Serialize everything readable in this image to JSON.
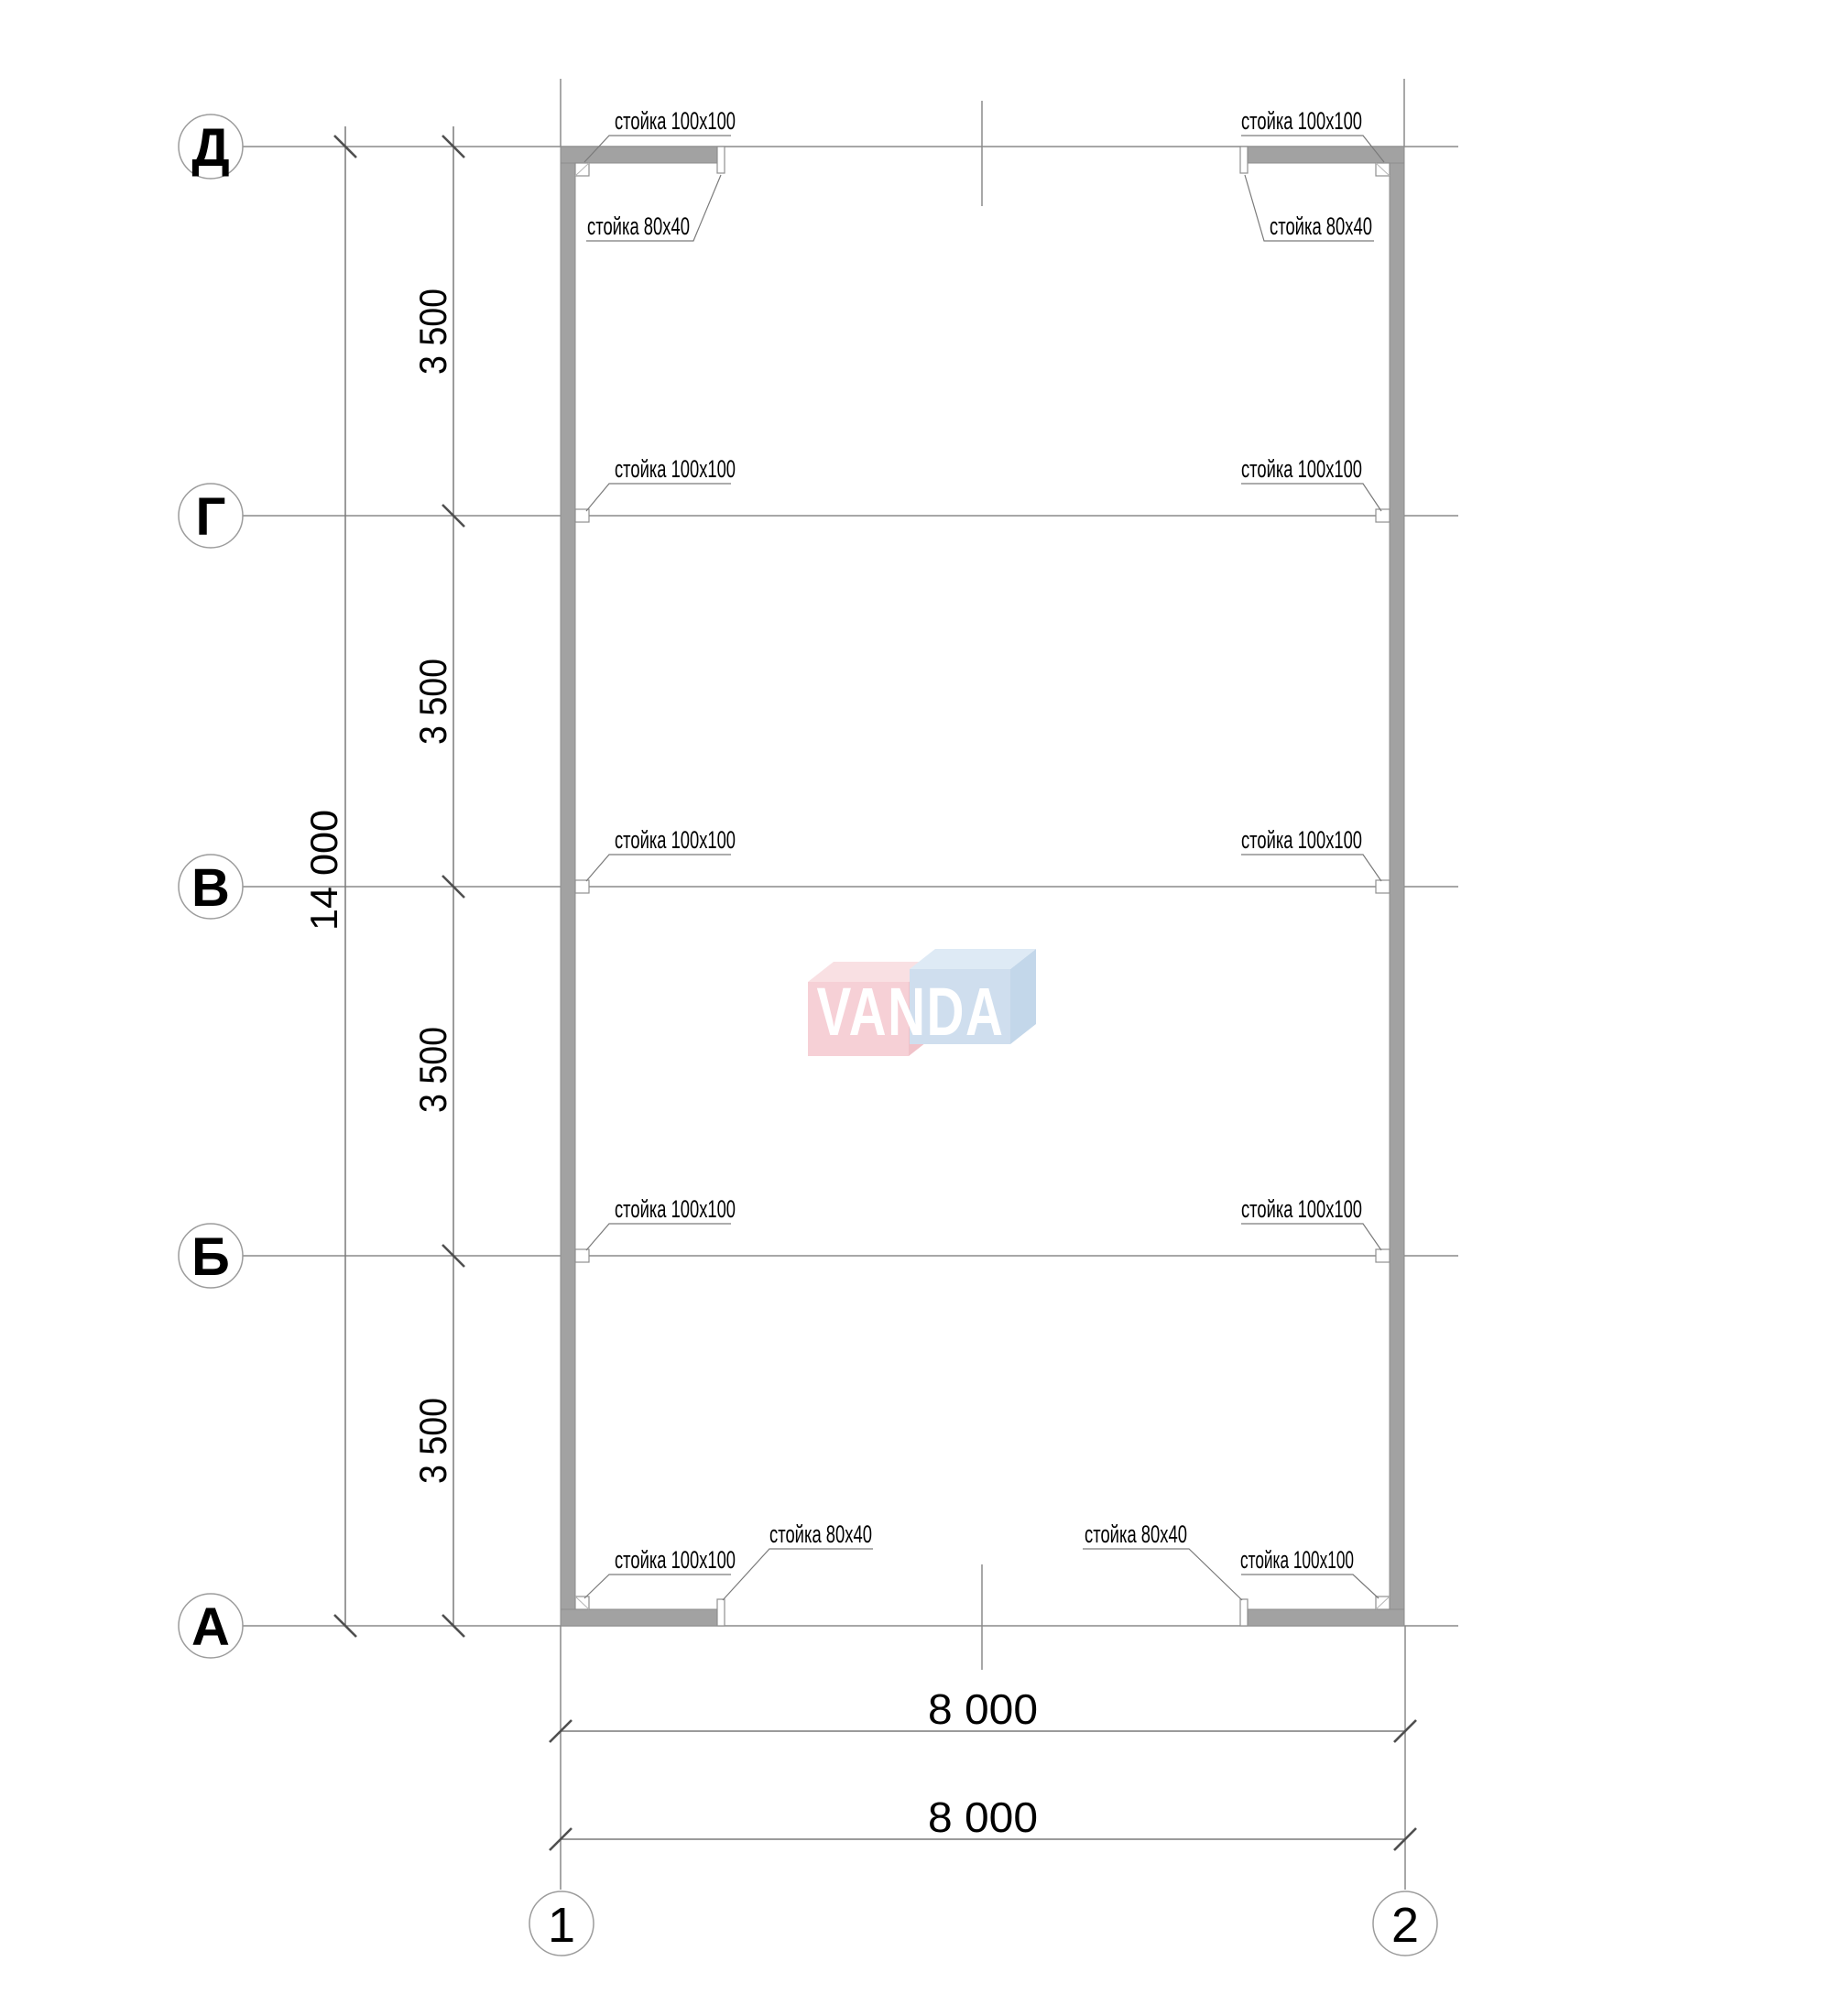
{
  "axes": {
    "rows": [
      {
        "label": "Д"
      },
      {
        "label": "Г"
      },
      {
        "label": "В"
      },
      {
        "label": "Б"
      },
      {
        "label": "А"
      }
    ],
    "cols": [
      {
        "label": "1"
      },
      {
        "label": "2"
      }
    ]
  },
  "dimensions": {
    "overall_height": "14 000",
    "segments": [
      "3 500",
      "3 500",
      "3 500",
      "3 500"
    ],
    "width_top": "8 000",
    "width_bottom": "8 000"
  },
  "annotations": [
    {
      "text": "стойка 100x100"
    },
    {
      "text": "стойка 80x40"
    },
    {
      "text": "стойка 100x100"
    },
    {
      "text": "стойка 80x40"
    },
    {
      "text": "стойка 100x100"
    },
    {
      "text": "стойка 100x100"
    },
    {
      "text": "стойка 100x100"
    },
    {
      "text": "стойка 100x100"
    },
    {
      "text": "стойка 100x100"
    },
    {
      "text": "стойка 100x100"
    },
    {
      "text": "стойка 100x100"
    },
    {
      "text": "стойка 80x40"
    },
    {
      "text": "стойка 80x40"
    },
    {
      "text": "стойка 100x100"
    }
  ],
  "watermark": {
    "text": "VANDA",
    "pink_front": "#f6ced4",
    "pink_top": "#f9dfe2",
    "pink_side": "#f0bfc7",
    "blue_front": "#cdddee",
    "blue_top": "#dde9f5",
    "blue_side": "#c0d5e9"
  },
  "colors": {
    "wall": "#a2a2a2"
  }
}
